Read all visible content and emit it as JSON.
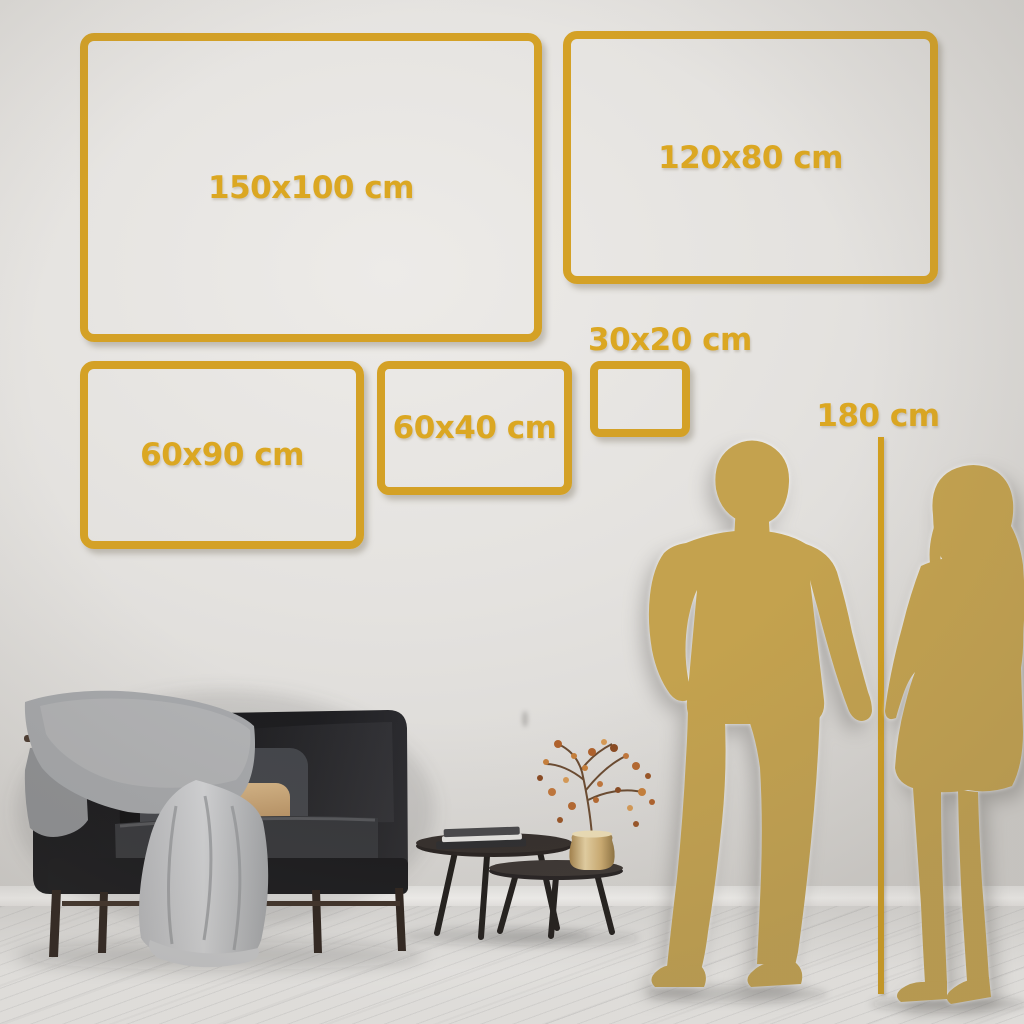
{
  "palette": {
    "accent_gold": "#d4a126",
    "label_gold": "#dba722",
    "silhouette_gold": "#c4a24e",
    "wall": "#e4e2df",
    "floor": "#f3f2f0"
  },
  "size_guide": {
    "frames": [
      {
        "id": "150x100",
        "label": "150x100 cm"
      },
      {
        "id": "120x80",
        "label": "120x80 cm"
      },
      {
        "id": "60x90",
        "label": "60x90 cm"
      },
      {
        "id": "60x40",
        "label": "60x40 cm"
      },
      {
        "id": "30x20",
        "label": "30x20 cm"
      }
    ],
    "height_reference": {
      "label": "180 cm"
    }
  }
}
